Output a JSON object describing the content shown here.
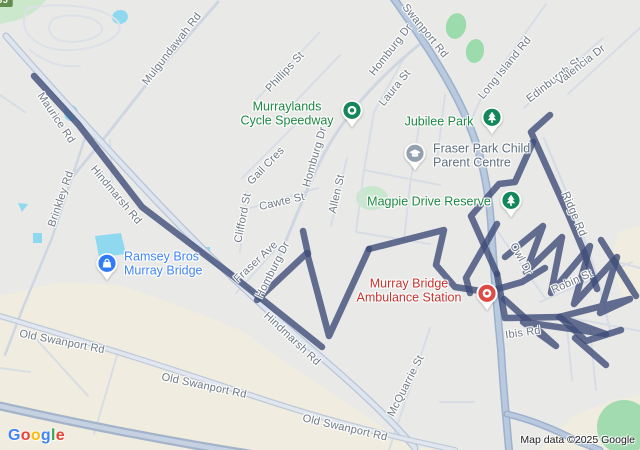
{
  "map": {
    "attribution": "Map data ©2025 Google",
    "google_logo": {
      "text": "Google",
      "letter_colors": [
        "#4285F4",
        "#EA4335",
        "#FBBC05",
        "#4285F4",
        "#34A853",
        "#EA4335"
      ]
    },
    "route_shield": {
      "label": "335",
      "bg": "#638F4E",
      "x": 487,
      "y": 227
    },
    "colors": {
      "background": "#E9EAE8",
      "route_overlay": "#3E4C78",
      "highway": "#B9C9DE",
      "road_major": "#DFE5EE",
      "road_minor": "#D8DDE5",
      "water": "#8FD9F0",
      "park_green": "#9CDBAB",
      "commercial_beige": "#F0ECDF",
      "label_road": "#6E7884",
      "label_park": "#1E8843",
      "label_shopping": "#4285F4",
      "label_health": "#C5342F",
      "label_school": "#5F7080"
    },
    "road_labels": [
      {
        "text": "Mulgundawah Rd",
        "x": 172,
        "y": 49,
        "rot": -52
      },
      {
        "text": "Swanport Rd",
        "x": 425,
        "y": 31,
        "rot": 51
      },
      {
        "text": "Maurice Rd",
        "x": 56,
        "y": 118,
        "rot": 56
      },
      {
        "text": "Hindmarsh Rd",
        "x": 116,
        "y": 195,
        "rot": 50
      },
      {
        "text": "Hindmarsh Rd",
        "x": 292,
        "y": 339,
        "rot": 43
      },
      {
        "text": "Brinkley Rd",
        "x": 61,
        "y": 199,
        "rot": -71
      },
      {
        "text": "Phillips St",
        "x": 285,
        "y": 72,
        "rot": -47
      },
      {
        "text": "Homburg Dr",
        "x": 391,
        "y": 50,
        "rot": -52
      },
      {
        "text": "Homburg Dr",
        "x": 315,
        "y": 157,
        "rot": -74
      },
      {
        "text": "Homburg Dr",
        "x": 273,
        "y": 270,
        "rot": -63
      },
      {
        "text": "Laura St",
        "x": 395,
        "y": 88,
        "rot": -51
      },
      {
        "text": "Long Island Rd",
        "x": 505,
        "y": 68,
        "rot": -51
      },
      {
        "text": "Edinburgh St",
        "x": 554,
        "y": 80,
        "rot": -38
      },
      {
        "text": "Valencia Dr",
        "x": 581,
        "y": 65,
        "rot": -38
      },
      {
        "text": "Gail Cres",
        "x": 266,
        "y": 166,
        "rot": -46
      },
      {
        "text": "Cawte St",
        "x": 282,
        "y": 202,
        "rot": -13
      },
      {
        "text": "Clifford St",
        "x": 243,
        "y": 218,
        "rot": -79
      },
      {
        "text": "Allen St",
        "x": 337,
        "y": 194,
        "rot": -77
      },
      {
        "text": "Fraser Ave",
        "x": 256,
        "y": 262,
        "rot": -43
      },
      {
        "text": "Ridge Rd",
        "x": 574,
        "y": 214,
        "rot": 67
      },
      {
        "text": "Owl Dr",
        "x": 521,
        "y": 259,
        "rot": 61
      },
      {
        "text": "Robin St",
        "x": 572,
        "y": 282,
        "rot": -24
      },
      {
        "text": "Ibis Rd",
        "x": 523,
        "y": 333,
        "rot": -8
      },
      {
        "text": "McQuarrie St",
        "x": 406,
        "y": 386,
        "rot": -63
      },
      {
        "text": "Old Swanport Rd",
        "x": 62,
        "y": 342,
        "rot": 11
      },
      {
        "text": "Old Swanport Rd",
        "x": 204,
        "y": 386,
        "rot": 12
      },
      {
        "text": "Old Swanport Rd",
        "x": 345,
        "y": 428,
        "rot": 13
      }
    ],
    "pois": [
      {
        "name": "murraylands-cycle-speedway",
        "lines": [
          "Murraylands",
          "Cycle Speedway"
        ],
        "text_color": "#1E8843",
        "align": "center",
        "label_x": 287,
        "label_y": 114,
        "pin_x": 352,
        "pin_y": 110,
        "icon": "ring-icon",
        "pin_color": "#12875A"
      },
      {
        "name": "jubilee-park",
        "lines": [
          "Jubilee Park"
        ],
        "text_color": "#1E8843",
        "align": "center",
        "label_x": 439,
        "label_y": 122,
        "pin_x": 492,
        "pin_y": 117,
        "icon": "tree-icon",
        "pin_color": "#12875A"
      },
      {
        "name": "fraser-park-child-parent-centre",
        "lines": [
          "Fraser Park Child",
          "Parent Centre"
        ],
        "text_color": "#5F7080",
        "align": "left",
        "label_x": 433,
        "label_y": 156,
        "pin_x": 415,
        "pin_y": 153,
        "icon": "school-icon",
        "pin_color": "#93A1AE"
      },
      {
        "name": "magpie-drive-reserve",
        "lines": [
          "Magpie Drive Reserve"
        ],
        "text_color": "#1E8843",
        "align": "center",
        "label_x": 429,
        "label_y": 202,
        "pin_x": 511,
        "pin_y": 200,
        "icon": "tree-icon",
        "pin_color": "#12875A"
      },
      {
        "name": "ramsey-bros-murray-bridge",
        "lines": [
          "Ramsey Bros",
          "Murray Bridge"
        ],
        "text_color": "#4285F4",
        "align": "left",
        "label_x": 124,
        "label_y": 264,
        "pin_x": 107,
        "pin_y": 263,
        "icon": "bag-icon",
        "pin_color": "#2F7CF6"
      },
      {
        "name": "murray-bridge-ambulance-station",
        "lines": [
          "Murray Bridge",
          "Ambulance Station"
        ],
        "text_color": "#C5342F",
        "align": "center",
        "label_x": 409,
        "label_y": 291,
        "pin_x": 487,
        "pin_y": 293,
        "icon": "medical-icon",
        "pin_color": "#DD4B43"
      }
    ]
  }
}
